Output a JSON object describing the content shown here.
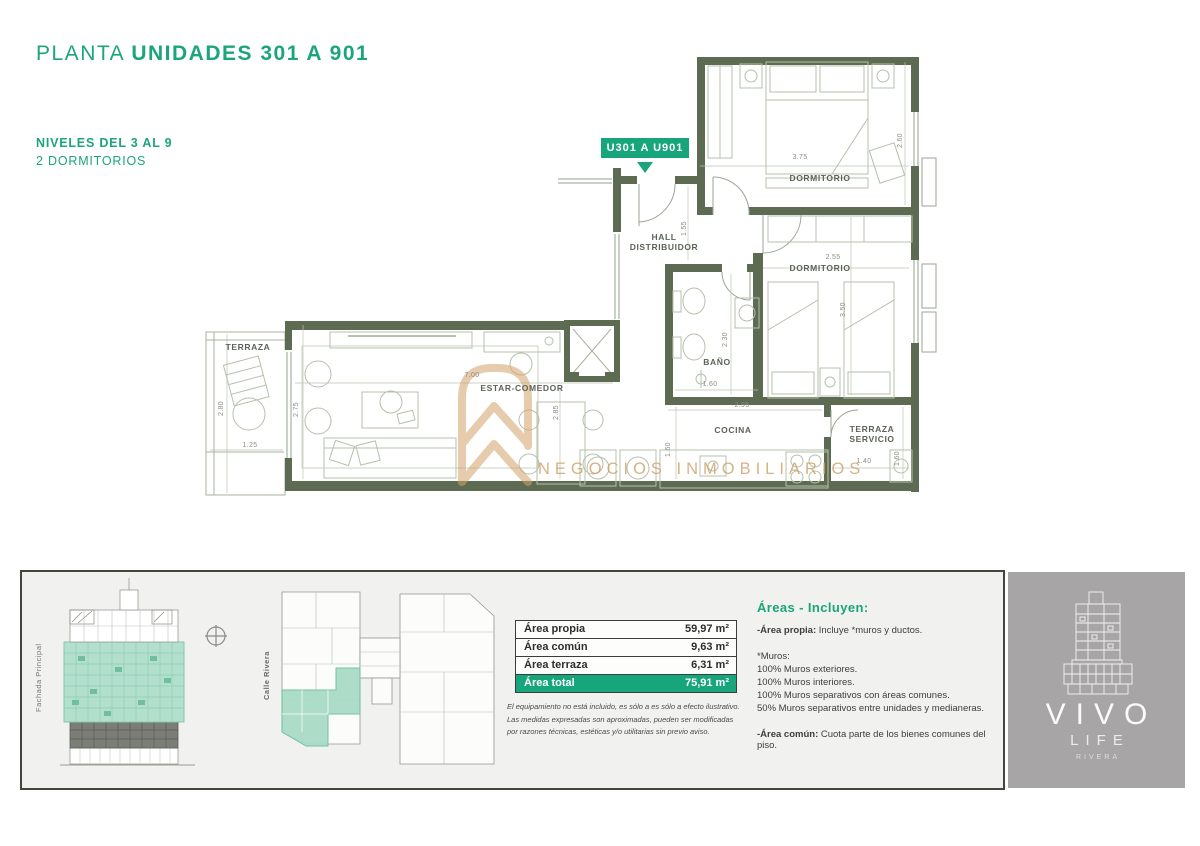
{
  "colors": {
    "accent_green": "#1ca57d",
    "badge_green": "#17a57c",
    "wall_olive": "#5d6b52",
    "watermark_gold": "#cda066",
    "highlight_teal": "#a9dcc6",
    "strip_bg": "#f1f1ef",
    "logo_gray": "#a7a5a6"
  },
  "header": {
    "title_light": "PLANTA",
    "title_bold": "UNIDADES 301 A 901",
    "level_line": "NIVELES DEL 3 AL 9",
    "type_line": "2 DORMITORIOS"
  },
  "plan": {
    "unit_badge": "U301 A U901",
    "rooms": [
      "DORMITORIO",
      "DORMITORIO",
      "HALL\nDISTRIBUIDOR",
      "BAÑO",
      "COCINA",
      "TERRAZA\nSERVICIO",
      "ESTAR-COMEDOR",
      "TERRAZA"
    ],
    "dims": [
      "3.75",
      "2.60",
      "1.55",
      "2.55",
      "3.50",
      "2.30",
      "1.60",
      "2.95",
      "1.60",
      "1.40",
      "1.60",
      "7.00",
      "2.75",
      "2.85",
      "2.80",
      "1.25"
    ]
  },
  "watermark": {
    "text": "NEGOCIOS INMOBILIARIOS"
  },
  "strip": {
    "elevation_label": "Fachada Principal",
    "street_label": "Calle Rivera",
    "table": {
      "rows": [
        {
          "label": "Área propia",
          "value": "59,97 m²"
        },
        {
          "label": "Área común",
          "value": "9,63 m²"
        },
        {
          "label": "Área terraza",
          "value": "6,31 m²"
        },
        {
          "label": "Área total",
          "value": "75,91 m²"
        }
      ]
    },
    "disclaimer": [
      "El equipamiento no está incluido, es sólo a es sólo a efecto ilustrativo.",
      "Las medidas expresadas son aproximadas, pueden ser modificadas",
      "por razones técnicas, estéticas y/o utilitarias sin previo aviso."
    ],
    "areas": {
      "heading": "Áreas - Incluyen:",
      "propia_b": "-Área propia:",
      "propia_t": " Incluye *muros y ductos.",
      "muros_title": "*Muros:",
      "muros": [
        "100% Muros exteriores.",
        "100% Muros interiores.",
        "100% Muros separativos con áreas comunes.",
        "50% Muros separativos entre unidades y medianeras."
      ],
      "comun_b": "-Área común:",
      "comun_t": " Cuota parte de los bienes comunes del piso."
    }
  },
  "logo": {
    "name": "VIVO",
    "sub": "LIFE",
    "city": "RIVERA"
  }
}
